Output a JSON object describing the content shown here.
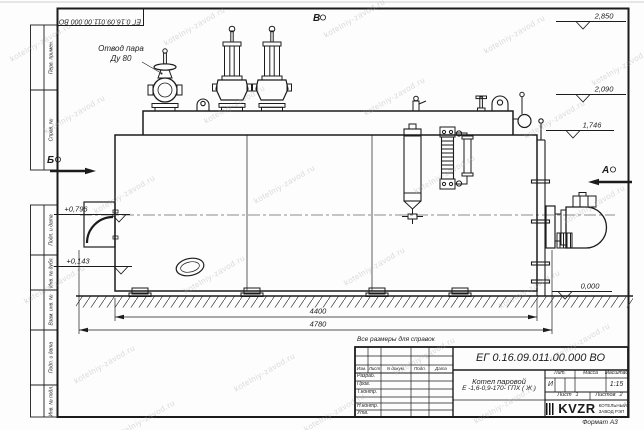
{
  "watermark": {
    "text": "kotelniy-zavod.ru"
  },
  "frame": {
    "doc_number_rotated": "ЕГ 0.16.09.011.00.000  ВО",
    "stamps": [
      "Перв. примен.",
      "Справ. №",
      "Подп. и дата",
      "Инв. № дубл.",
      "Взам. инв. №",
      "Подп. и дата",
      "Инв. № подл."
    ],
    "format_label": "Формат А3"
  },
  "title_block": {
    "doc_number": "ЕГ 0.16.09.011.00.000  ВО",
    "product_name": "Котел паровой",
    "product_designation": "Е -1,6-0,9-170- ГПХ ( Ж )",
    "note_above": "Все размеры для справок",
    "col_headers": [
      "Изм.",
      "Лист",
      "N докум.",
      "Подп.",
      "Дата"
    ],
    "row_labels": [
      "Разраб.",
      "Пров.",
      "Т.контр.",
      "Н.контр.",
      "Утв."
    ],
    "lit_header": "Лит.",
    "mass_header": "Масса",
    "scale_header": "Масштаб",
    "lit_value": "И",
    "scale_value": "1:15",
    "sheet_label": "Лист",
    "sheet_value": "1",
    "sheets_label": "Листов",
    "sheets_value": "2",
    "company": {
      "logo": "KVZR",
      "line1": "КОТЕЛЬНЫЙ",
      "line2": "ЗАВОД РЭП"
    }
  },
  "drawing": {
    "callout": {
      "line1": "Отвод пара",
      "line2": "Ду 80"
    },
    "views": {
      "a": "А",
      "b": "Б",
      "v": "В"
    },
    "elevations": {
      "top": "2,850",
      "mid": "2,090",
      "low": "1,746",
      "left_upper": "+0,796",
      "left_lower": "+0,143",
      "ground": "0,000"
    },
    "dims": {
      "body_length": "4400",
      "overall_length": "4780"
    }
  }
}
